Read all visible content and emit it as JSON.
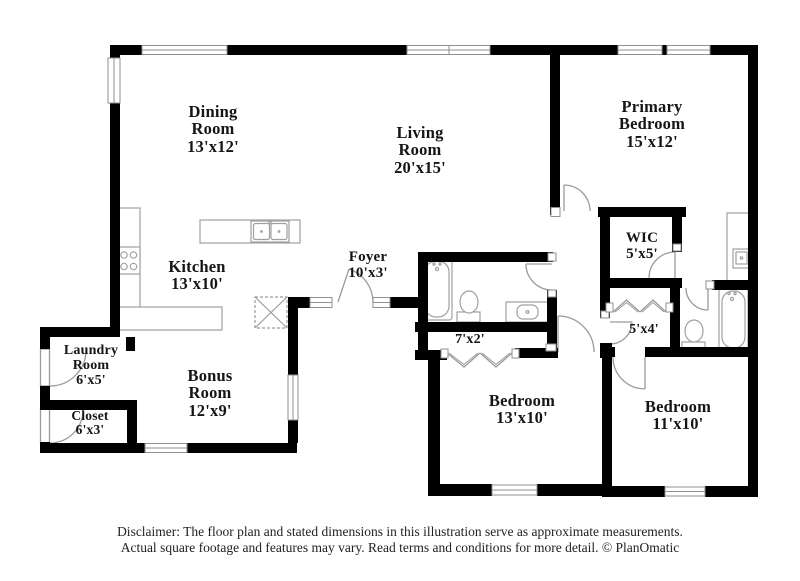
{
  "floor_plan": {
    "rooms": [
      {
        "name": "Dining Room",
        "dims": "13'x12'"
      },
      {
        "name": "Living Room",
        "dims": "20'x15'"
      },
      {
        "name": "Primary Bedroom",
        "dims": "15'x12'"
      },
      {
        "name": "Kitchen",
        "dims": "13'x10'"
      },
      {
        "name": "Foyer",
        "dims": "10'x3'"
      },
      {
        "name": "WIC",
        "dims": "5'x5'"
      },
      {
        "name": "Laundry Room",
        "dims": "6'x5'"
      },
      {
        "name": "Closet",
        "dims": "6'x3'"
      },
      {
        "name": "Bonus Room",
        "dims": "12'x9'"
      },
      {
        "name": "Bedroom",
        "dims": "13'x10'"
      },
      {
        "name": "Bedroom",
        "dims": "11'x10'"
      },
      {
        "name": "",
        "dims": "7'x2'"
      },
      {
        "name": "",
        "dims": "5'x4'"
      }
    ],
    "icons": [
      "wall",
      "window",
      "door-swing-icon",
      "bifold-door-icon",
      "bathtub-icon",
      "toilet-icon",
      "sink-icon",
      "stove-icon",
      "kitchen-island-icon",
      "attic-access-icon"
    ],
    "colors": {
      "wall": "#000000",
      "fixture_line": "#9b9b9b",
      "background": "#ffffff",
      "text": "#151515"
    }
  },
  "footer": {
    "disclaimer_line1": "Disclaimer: The floor plan and stated dimensions in this illustration serve as approximate measurements.",
    "disclaimer_line2": "Actual square footage and features may vary. Read terms and conditions for more detail. © PlanOmatic"
  }
}
